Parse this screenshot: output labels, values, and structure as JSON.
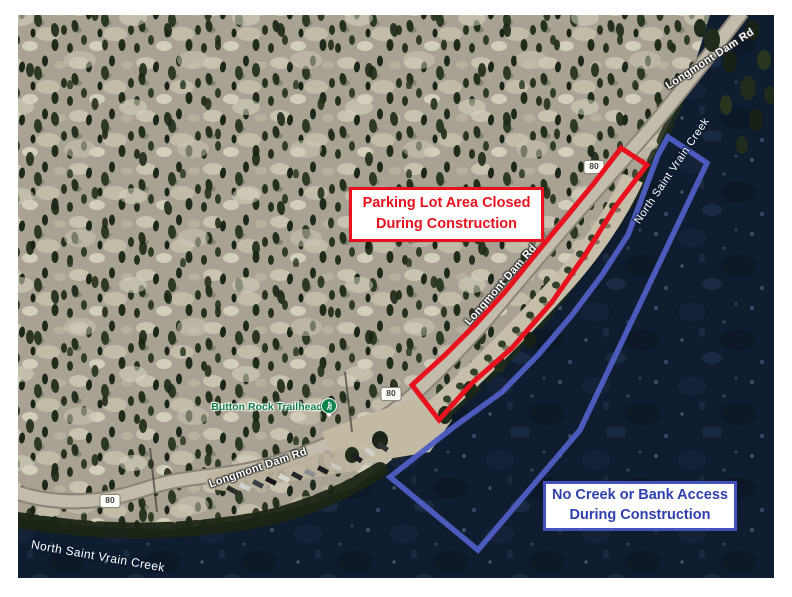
{
  "map_labels": {
    "road": "Longmont Dam Rd",
    "creek": "North Saint Vrain Creek",
    "trailhead": "Button Rock Trailhead",
    "route_shield": "80"
  },
  "callouts": {
    "parking_closed": {
      "line1": "Parking Lot Area Closed",
      "line2": "During Construction",
      "accent_color": "#e8121e"
    },
    "no_creek_access": {
      "line1": "No Creek or Bank Access",
      "line2": "During Construction",
      "accent_color": "#4254bb"
    }
  },
  "zone_colors": {
    "parking_outline": "#e8121e",
    "creek_outline": "#4f5fc4"
  }
}
